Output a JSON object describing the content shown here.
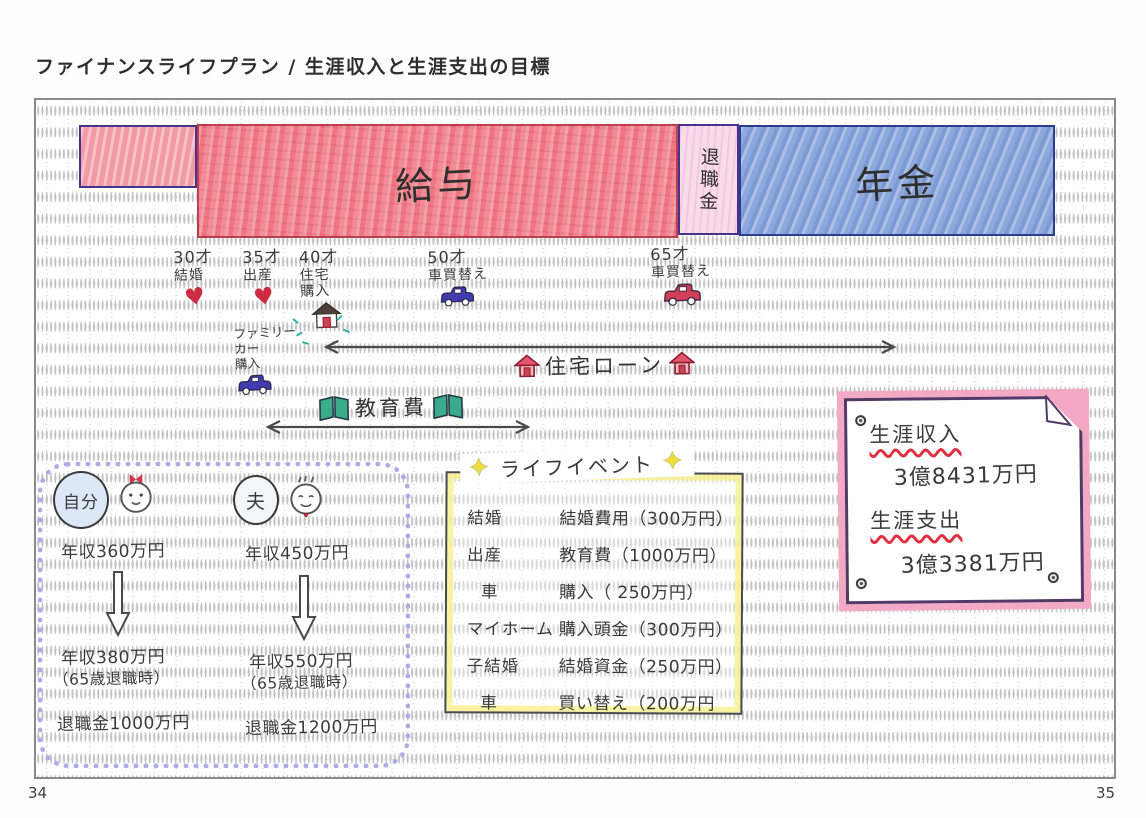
{
  "title": "ファイナンスライフプラン / 生涯収入と生涯支出の目標",
  "pages": {
    "left": "34",
    "right": "35"
  },
  "timeline": {
    "salary": "給与",
    "retirement_bonus": "退職金",
    "pension": "年金"
  },
  "milestones": [
    {
      "age": "30才",
      "line1": "結婚",
      "line2": ""
    },
    {
      "age": "35才",
      "line1": "出産",
      "line2": ""
    },
    {
      "age": "40才",
      "line1": "住宅",
      "line2": "購入"
    },
    {
      "age": "50才",
      "line1": "車買替え",
      "line2": ""
    },
    {
      "age": "65才",
      "line1": "車買替え",
      "line2": ""
    }
  ],
  "family_car": {
    "line1": "ファミリー",
    "line2": "カー",
    "line3": "購入"
  },
  "arrows": {
    "housing_loan": "住宅ローン",
    "education": "教育費"
  },
  "persons": [
    {
      "name": "自分",
      "income_now": "年収360万円",
      "income_future": "年収380万円",
      "note": "（65歳退職時）",
      "retirement": "退職金1000万円"
    },
    {
      "name": "夫",
      "income_now": "年収450万円",
      "income_future": "年収550万円",
      "note": "（65歳退職時）",
      "retirement": "退職金1200万円"
    }
  ],
  "life_events": {
    "title": "ライフイベント",
    "rows": [
      {
        "item": "結婚",
        "cost": "結婚費用（300万円）"
      },
      {
        "item": "出産",
        "cost": "教育費（1000万円）"
      },
      {
        "item": "車",
        "cost": "購入（ 250万円）"
      },
      {
        "item": "マイホーム",
        "cost": "購入頭金（300万円）"
      },
      {
        "item": "子結婚",
        "cost": "結婚資金（250万円）"
      },
      {
        "item": "車",
        "cost": "買い替え（200万円"
      }
    ]
  },
  "summary": {
    "income_label": "生涯収入",
    "income_value": "3億8431万円",
    "expense_label": "生涯支出",
    "expense_value": "3億3381万円"
  },
  "icons": {
    "heart": "♥",
    "star": "✦"
  },
  "colors": {
    "salary_red": "#ef7783",
    "retirement_pink": "#f8dcea",
    "pension_blue": "#8ca8dc",
    "outline_purple": "#45338e",
    "note_pink": "#f3a8c3",
    "underline_red": "#e03040",
    "highlight_yellow": "#f7f08c",
    "cloud_purple": "#aeace6"
  }
}
